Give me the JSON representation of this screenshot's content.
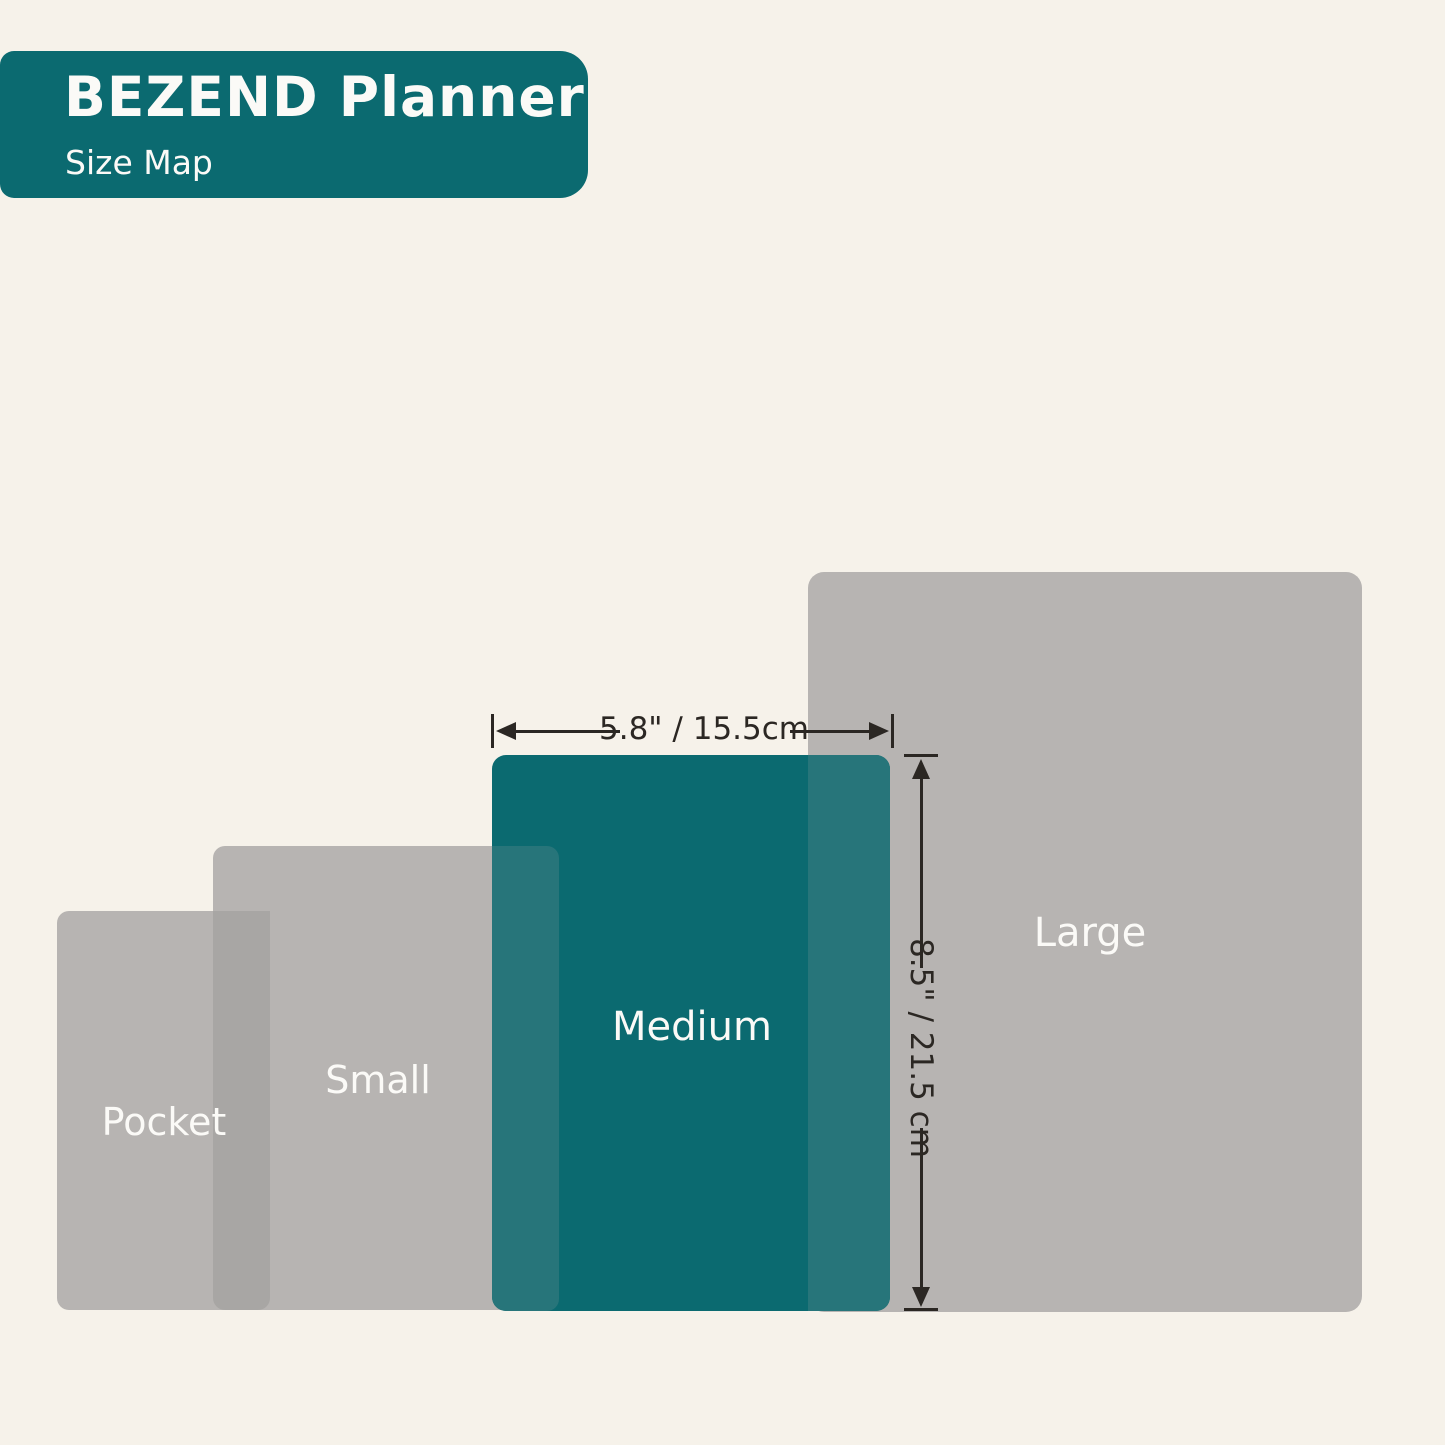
{
  "header": {
    "title": "BEZEND Planner",
    "subtitle": "Size Map"
  },
  "sizes": [
    {
      "label": "Pocket"
    },
    {
      "label": "Small"
    },
    {
      "label": "Medium"
    },
    {
      "label": "Large"
    }
  ],
  "dimensions": {
    "width_label": "5.8\" / 15.5cm",
    "height_label": "8.5\" / 21.5 cm"
  },
  "colors": {
    "cream": "#F6F2EA",
    "teal": "#0B6A70",
    "gray": "#B7B4B2",
    "gray_overlap": "#A8A6A4",
    "teal_overlap": "#27757A",
    "ink": "#2B2723",
    "label": "#FBFAF7"
  }
}
